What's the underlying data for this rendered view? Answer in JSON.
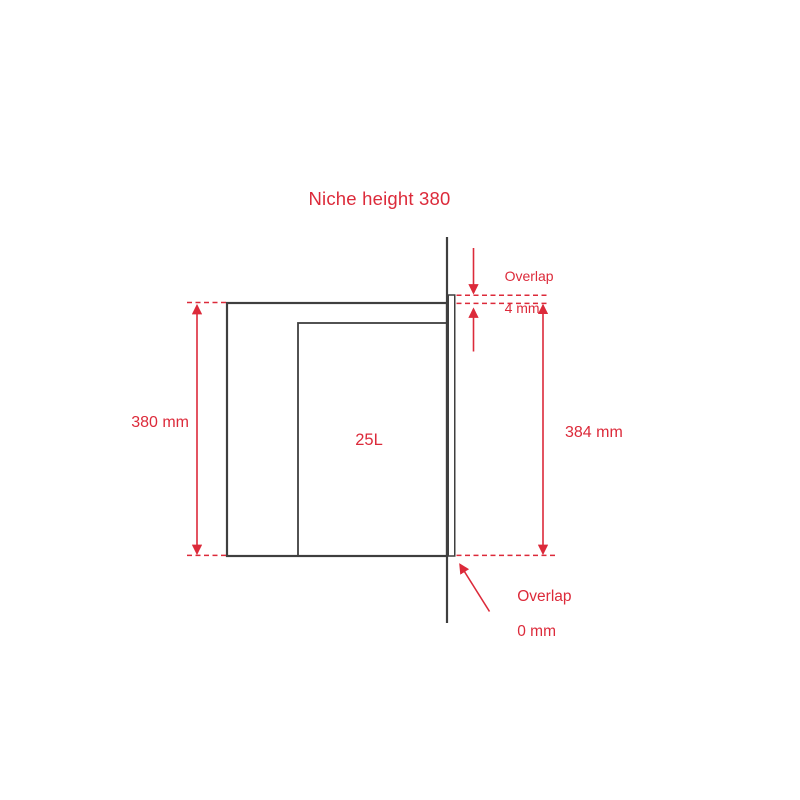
{
  "title": "Niche height 380",
  "colors": {
    "accent": "#dc2a3a",
    "line": "#3f3f3f",
    "background": "#ffffff"
  },
  "diagram": {
    "niche_height_label": "380 mm",
    "door_height_label": "384 mm",
    "overlap_top": {
      "line1": "Overlap",
      "line2": "4 mm"
    },
    "overlap_bottom": {
      "line1": "Overlap",
      "line2": "0 mm"
    },
    "cavity_volume": "25L"
  }
}
